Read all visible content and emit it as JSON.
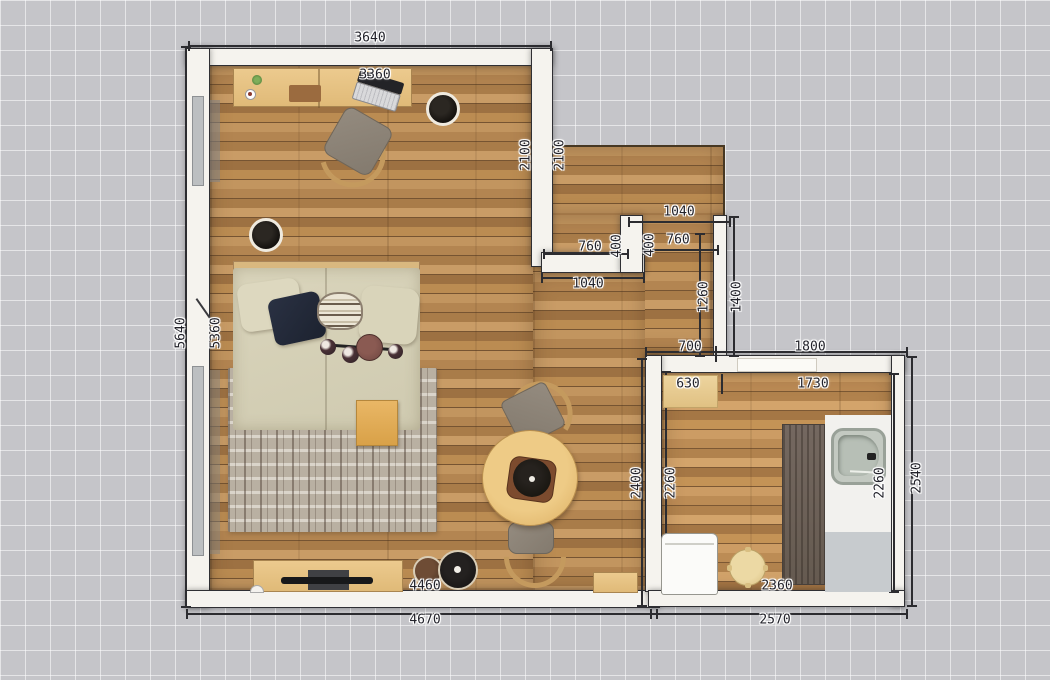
{
  "scene": {
    "type": "2d-floor-plan-top-view",
    "canvas_width_px": 1050,
    "canvas_height_px": 680
  },
  "colors": {
    "background_grid": "#c5c5c9",
    "grid_line": "#ffffff",
    "wall": "#f5f3ee",
    "wall_edge": "#2f2f33",
    "floor_wood": "#b08352",
    "dimension_text": "#23232b",
    "bed_fabric": "#d6d1b6",
    "navy_pillow": "#232a3a",
    "rug": "#b9b0a2",
    "sink": "#c3c9c1",
    "dark_runner": "#6b6057"
  },
  "dimensions": [
    {
      "id": "top-outer-width",
      "label": "3640",
      "x": 370,
      "y": 38,
      "rot": 0
    },
    {
      "id": "top-inner-width",
      "label": "3360",
      "x": 375,
      "y": 75,
      "rot": 0
    },
    {
      "id": "upper-right-outer",
      "label": "2100",
      "x": 526,
      "y": 155,
      "rot": -90
    },
    {
      "id": "upper-right-inner",
      "label": "2100",
      "x": 560,
      "y": 155,
      "rot": -90
    },
    {
      "id": "hall-top-width",
      "label": "1040",
      "x": 679,
      "y": 212,
      "rot": 0
    },
    {
      "id": "notch-left-width",
      "label": "760",
      "x": 590,
      "y": 247,
      "rot": 0
    },
    {
      "id": "notch-left-depth",
      "label": "400",
      "x": 617,
      "y": 246,
      "rot": -90
    },
    {
      "id": "notch-right-depth",
      "label": "400",
      "x": 650,
      "y": 245,
      "rot": -90
    },
    {
      "id": "notch-right-width",
      "label": "760",
      "x": 678,
      "y": 240,
      "rot": 0
    },
    {
      "id": "hall-bottom-width",
      "label": "1040",
      "x": 588,
      "y": 284,
      "rot": 0
    },
    {
      "id": "hall-inner-length",
      "label": "1260",
      "x": 704,
      "y": 297,
      "rot": -90
    },
    {
      "id": "hall-outer-length",
      "label": "1400",
      "x": 737,
      "y": 297,
      "rot": -90
    },
    {
      "id": "left-outer-height",
      "label": "5640",
      "x": 181,
      "y": 333,
      "rot": -90
    },
    {
      "id": "left-inner-height",
      "label": "5360",
      "x": 216,
      "y": 333,
      "rot": -90
    },
    {
      "id": "bath-top-left-outer",
      "label": "700",
      "x": 690,
      "y": 347,
      "rot": 0
    },
    {
      "id": "bath-top-right-outer",
      "label": "1800",
      "x": 810,
      "y": 347,
      "rot": 0
    },
    {
      "id": "bath-top-left-inner",
      "label": "630",
      "x": 688,
      "y": 384,
      "rot": 0
    },
    {
      "id": "bath-top-right-inner",
      "label": "1730",
      "x": 813,
      "y": 384,
      "rot": 0
    },
    {
      "id": "main-right-height",
      "label": "2400",
      "x": 637,
      "y": 483,
      "rot": -90
    },
    {
      "id": "bath-left-inner-height",
      "label": "2260",
      "x": 671,
      "y": 483,
      "rot": -90
    },
    {
      "id": "bath-right-inner-height",
      "label": "2260",
      "x": 880,
      "y": 483,
      "rot": -90
    },
    {
      "id": "bath-right-outer-height",
      "label": "2540",
      "x": 917,
      "y": 478,
      "rot": -90
    },
    {
      "id": "main-bottom-inner",
      "label": "4460",
      "x": 425,
      "y": 586,
      "rot": 0
    },
    {
      "id": "main-bottom-outer",
      "label": "4670",
      "x": 425,
      "y": 620,
      "rot": 0
    },
    {
      "id": "bath-bottom-inner",
      "label": "2360",
      "x": 777,
      "y": 586,
      "rot": 0
    },
    {
      "id": "bath-bottom-outer",
      "label": "2570",
      "x": 775,
      "y": 620,
      "rot": 0
    }
  ]
}
